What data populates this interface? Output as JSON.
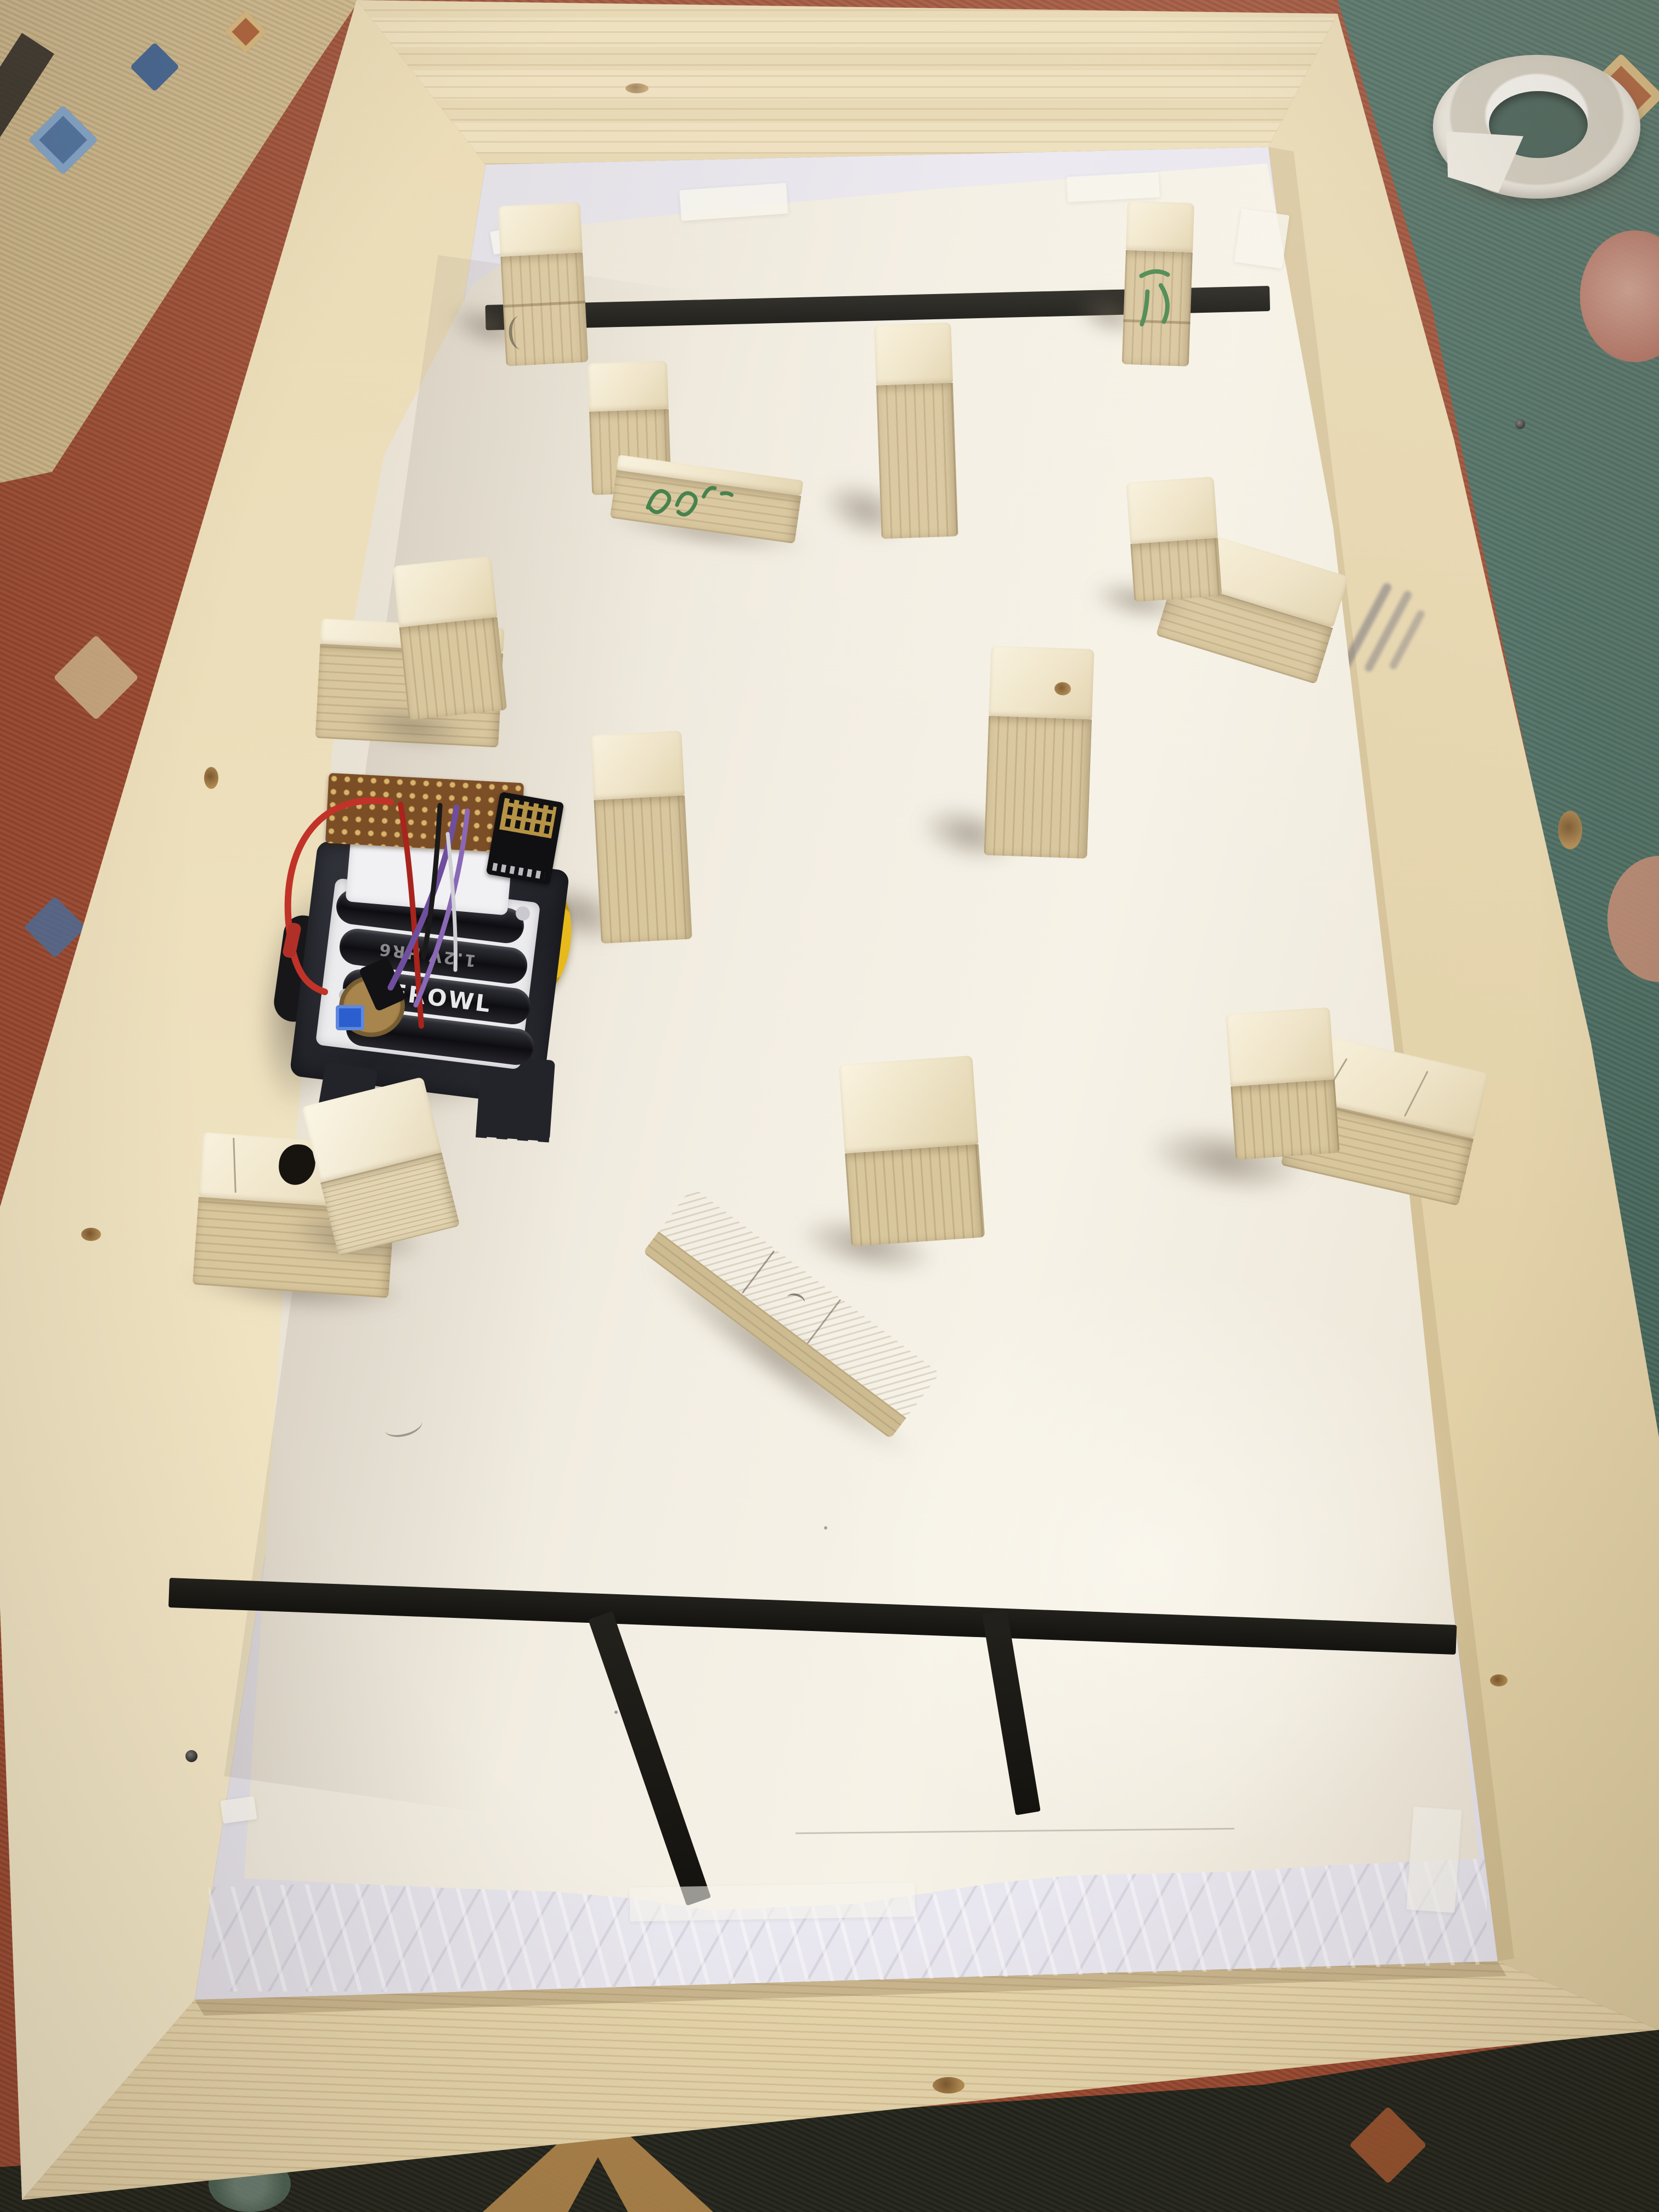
{
  "scene": {
    "type": "photograph",
    "setting": "Homemade robot arena: rectangular pine-lumber frame lying on an oriental kilim carpet; floor of the arena is white poster paper over a white plastic sheet; wooden blocks arranged as obstacles; black electrical-tape lines mark a start line at the top and a goal grid at the bottom; a small DIY battery-powered robot sits near the left wall.",
    "frame": {
      "label": "pine wooden frame",
      "rails": 4,
      "features": [
        "knots",
        "screw holes",
        "illegible lumber stamp on right rail"
      ]
    },
    "floor": {
      "paper": "cream-white poster paper with torn bottom edge",
      "underlay": "white embossed plastic sheet",
      "attachments": "pieces of masking tape and clear tape"
    },
    "tape_lines": {
      "color_hex": "#1b1a15",
      "top_line": "single horizontal strip between two standing blocks",
      "bottom_pattern": "horizontal strip with two short vertical strips hanging below (goal boxes)"
    },
    "blocks": {
      "count_groups": 11,
      "material": "pine offcuts",
      "kinds": [
        "tall standing posts",
        "flat beams",
        "cubes stacked on beams",
        "long beam with cube tower"
      ]
    },
    "carpet": {
      "zones": [
        "tan border band top-left",
        "black zigzag border",
        "terracotta field left",
        "teal field top-right with rose medallions",
        "dark green-black field bottom with tan arrow motif"
      ],
      "colors": {
        "terracotta": "#9c4a31",
        "tan": "#cdb687",
        "teal": "#4a6b60",
        "dark": "#23251c",
        "rose": "#c08a72",
        "blue_motif": "#4a6f9e"
      }
    },
    "tape_roll": {
      "label": "roll of white masking tape on carpet, top right"
    }
  },
  "robot": {
    "label": "DIY two-wheel robot",
    "parts": [
      "black textured chassis plate with toothed legs",
      "white 4xAA battery holder",
      "round perfboard with blue trimmer",
      "white servo bracket",
      "brown perfboard shield",
      "black ESP8266 WiFi module with meander antenna",
      "yellow gear wheel",
      "red, purple, black and white jumper wires"
    ],
    "battery_count": 4,
    "battery_brand_visible": "EROWL",
    "battery_rating_visible": "1.2V HR6",
    "colors": {
      "chassis": "#23242a",
      "wheel": "#e2b31c",
      "holder": "#ececee",
      "perfboard": "#7c4e26"
    }
  },
  "markings": {
    "green_marker_on_beam": "illegible green marker handwriting on flat beam",
    "green_marker_on_block": "illegible green marker mark on top-right post",
    "rail_stamp": "blurred blue-grey lumber stamp on right rail",
    "pencil": "faint pencil scribbles and cut lines on paper and blocks"
  },
  "wood_colors": {
    "top_face": "#f3ead3",
    "front_face": "#d8c69d",
    "rail": "#ebdcb6"
  }
}
